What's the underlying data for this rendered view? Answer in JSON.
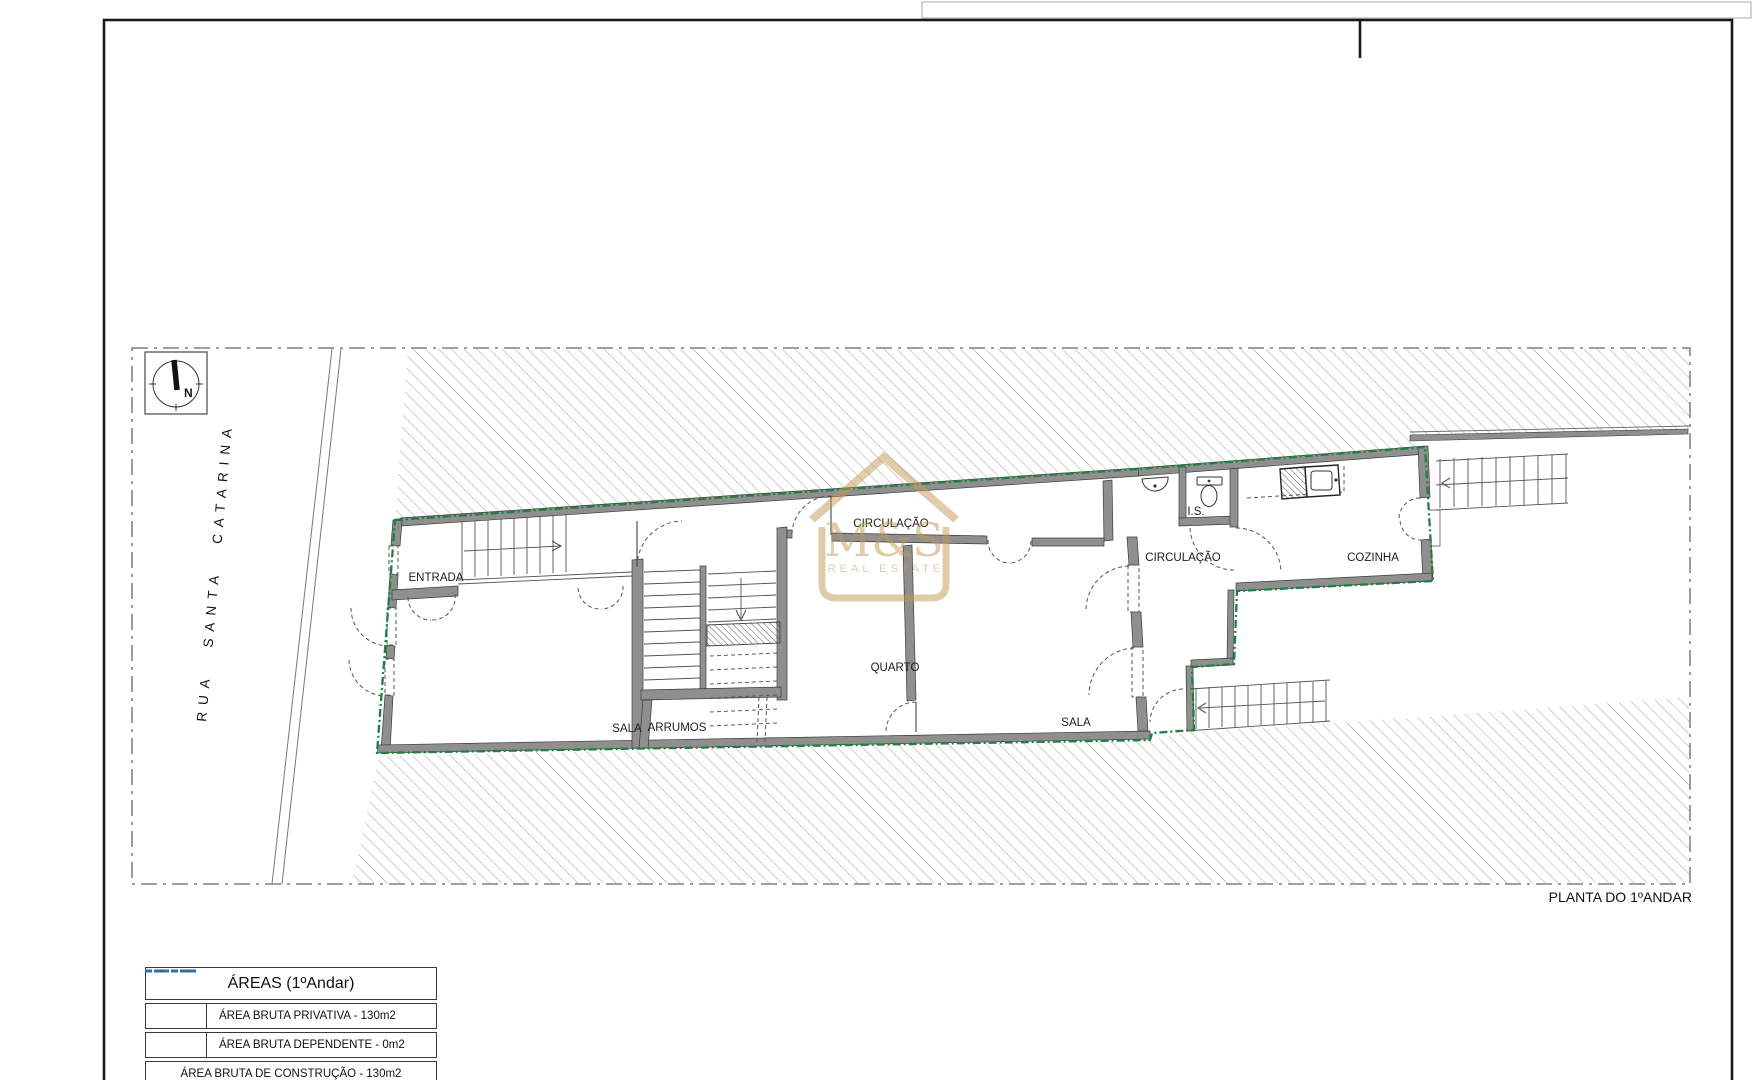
{
  "plan": {
    "title": "PLANTA DO 1ºANDAR"
  },
  "street": {
    "name": "RUA SANTA CATARINA"
  },
  "north": {
    "label": "N"
  },
  "rooms": {
    "entrada": "ENTRADA",
    "circulacao_main": "CIRCULAÇÃO",
    "sala_left": "SALA",
    "arrumos": "ARRUMOS",
    "quarto": "QUARTO",
    "sala_right": "SALA",
    "circulacao_rear": "CIRCULAÇÃO",
    "is": "I.S.",
    "cozinha": "COZINHA"
  },
  "watermark": {
    "name": "M&S",
    "tagline": "REAL ESTATE"
  },
  "legend": {
    "title": "ÁREAS (1ºAndar)",
    "rows": [
      {
        "label": "ÁREA BRUTA PRIVATIVA - 130m2",
        "symbol": "green-dashdot-line"
      },
      {
        "label": "ÁREA BRUTA DEPENDENTE - 0m2",
        "symbol": "blue-dashed-line"
      },
      {
        "label": "ÁREA BRUTA DE CONSTRUÇÃO - 130m2",
        "symbol": "none"
      }
    ]
  },
  "colors": {
    "property_line_green": "#1e8040",
    "dependente_blue": "#2f6db5",
    "watermark_gold": "#c39a55",
    "wall_gray": "#8f8f8f",
    "hatch_gray": "#979797",
    "site_line_gray": "#666666"
  }
}
